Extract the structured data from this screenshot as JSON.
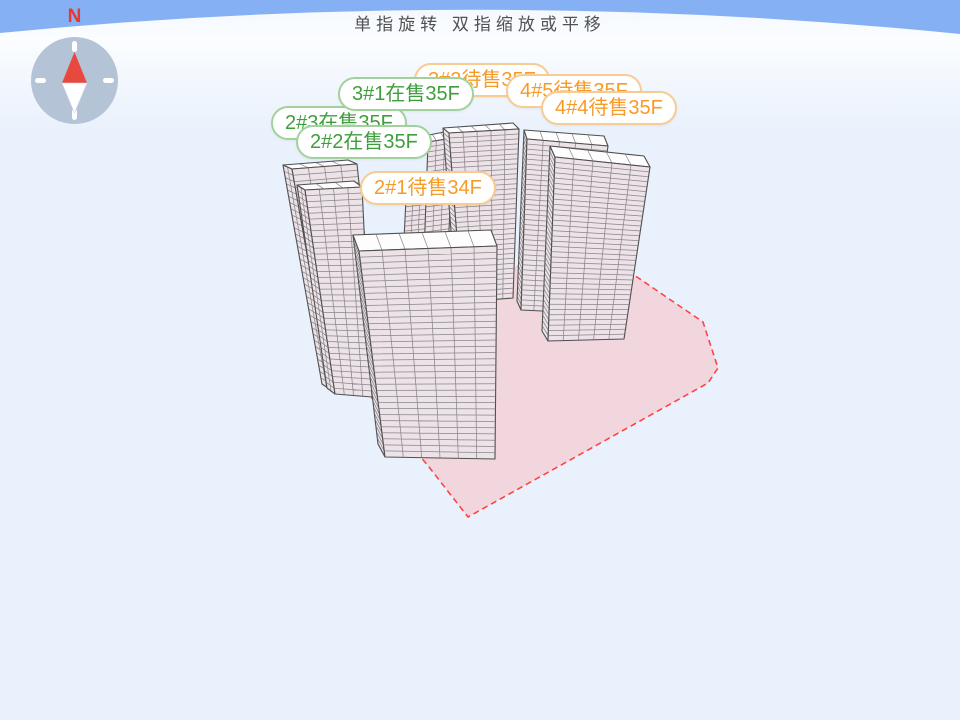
{
  "title": "单指旋转 双指缩放或平移",
  "compass": {
    "north_label": "N"
  },
  "labels": [
    {
      "id": "3-2",
      "text": "3#2待售35F",
      "status": "pending",
      "x": 414,
      "y": 63,
      "z": 1
    },
    {
      "id": "3-1",
      "text": "3#1在售35F",
      "status": "selling",
      "x": 338,
      "y": 77,
      "z": 2
    },
    {
      "id": "4-5",
      "text": "4#5待售35F",
      "status": "pending",
      "x": 506,
      "y": 74,
      "z": 3
    },
    {
      "id": "4-4",
      "text": "4#4待售35F",
      "status": "pending",
      "x": 541,
      "y": 91,
      "z": 4
    },
    {
      "id": "2-3",
      "text": "2#3在售35F",
      "status": "selling",
      "x": 271,
      "y": 106,
      "z": 1
    },
    {
      "id": "2-2",
      "text": "2#2在售35F",
      "status": "selling",
      "x": 296,
      "y": 125,
      "z": 2
    },
    {
      "id": "2-1",
      "text": "2#1待售34F",
      "status": "pending",
      "x": 360,
      "y": 171,
      "z": 2
    }
  ],
  "colors": {
    "sky_band": "#86b0f4",
    "bg_far": "#f2f7fe",
    "bg_glow": "#fbfdff",
    "bg_near": "#e9f1fc",
    "title_color": "#515151",
    "wall_fill": "#ece2e8",
    "roof_fill": "#fdfdfd",
    "grid_line": "#6f6f6f",
    "outline": "#4f4f4f",
    "ground_fill": "#f2d6dd",
    "ground_stroke": "#ff4242",
    "selling_text": "#3f9e3c",
    "selling_border": "#a3d19d",
    "pending_text": "#f79b28",
    "pending_border": "#f8cb92",
    "compass_circle": "#b5c3d7",
    "compass_tick": "#ffffff",
    "needle_red": "#e8493f",
    "needle_white": "#ffffff",
    "north_color": "#e8372c"
  },
  "scene": {
    "sky": {
      "left_y": 33,
      "ctrl_y": -14,
      "right_y": 34
    },
    "ground_polygon": [
      [
        371,
        397
      ],
      [
        500,
        268
      ],
      [
        560,
        262
      ],
      [
        637,
        277
      ],
      [
        703,
        322
      ],
      [
        718,
        368
      ],
      [
        708,
        383
      ],
      [
        468,
        517
      ],
      [
        429,
        467
      ]
    ],
    "buildings": [
      {
        "id": "back-tower-a",
        "faces": [
          {
            "kind": "wall",
            "p": [
              [
                407,
                178
              ],
              [
                428,
                175
              ],
              [
                424,
                258
              ],
              [
                403,
                260
              ]
            ],
            "rows": 16,
            "cols": 2
          }
        ]
      },
      {
        "id": "back-tower-b",
        "faces": [
          {
            "kind": "roof",
            "p": [
              [
                424,
                136
              ],
              [
                449,
                131
              ],
              [
                453,
                138
              ],
              [
                428,
                142
              ]
            ],
            "rows": 0,
            "cols": 2
          },
          {
            "kind": "wall",
            "p": [
              [
                428,
                142
              ],
              [
                453,
                138
              ],
              [
                448,
                254
              ],
              [
                424,
                257
              ]
            ],
            "rows": 22,
            "cols": 2
          }
        ]
      },
      {
        "id": "3-1",
        "faces": [
          {
            "kind": "wall",
            "p": [
              [
                443,
                128
              ],
              [
                449,
                133
              ],
              [
                462,
                302
              ],
              [
                456,
                295
              ]
            ],
            "rows": 33,
            "cols": 0
          },
          {
            "kind": "roof",
            "p": [
              [
                443,
                128
              ],
              [
                513,
                123
              ],
              [
                519,
                129
              ],
              [
                449,
                133
              ]
            ],
            "rows": 0,
            "cols": 4
          },
          {
            "kind": "wall",
            "p": [
              [
                449,
                133
              ],
              [
                519,
                129
              ],
              [
                513,
                298
              ],
              [
                462,
                302
              ]
            ],
            "rows": 33,
            "cols": 4
          }
        ]
      },
      {
        "id": "4-5",
        "faces": [
          {
            "kind": "wall",
            "p": [
              [
                524,
                130
              ],
              [
                527,
                139
              ],
              [
                521,
                310
              ],
              [
                517,
                301
              ]
            ],
            "rows": 33,
            "cols": 0
          },
          {
            "kind": "roof",
            "p": [
              [
                524,
                130
              ],
              [
                604,
                136
              ],
              [
                608,
                146
              ],
              [
                527,
                139
              ]
            ],
            "rows": 0,
            "cols": 4
          },
          {
            "kind": "wall",
            "p": [
              [
                527,
                139
              ],
              [
                608,
                146
              ],
              [
                585,
                313
              ],
              [
                521,
                310
              ]
            ],
            "rows": 33,
            "cols": 4
          }
        ]
      },
      {
        "id": "4-4",
        "faces": [
          {
            "kind": "wall",
            "p": [
              [
                550,
                146
              ],
              [
                555,
                157
              ],
              [
                548,
                341
              ],
              [
                542,
                331
              ]
            ],
            "rows": 34,
            "cols": 0
          },
          {
            "kind": "roof",
            "p": [
              [
                550,
                146
              ],
              [
                644,
                156
              ],
              [
                650,
                167
              ],
              [
                555,
                157
              ]
            ],
            "rows": 0,
            "cols": 4
          },
          {
            "kind": "wall",
            "p": [
              [
                555,
                157
              ],
              [
                650,
                167
              ],
              [
                624,
                339
              ],
              [
                548,
                341
              ]
            ],
            "rows": 34,
            "cols": 4
          }
        ]
      },
      {
        "id": "2-3",
        "faces": [
          {
            "kind": "wall",
            "p": [
              [
                283,
                165
              ],
              [
                292,
                169
              ],
              [
                331,
                390
              ],
              [
                322,
                384
              ]
            ],
            "rows": 34,
            "cols": 1
          },
          {
            "kind": "roof",
            "p": [
              [
                283,
                165
              ],
              [
                348,
                160
              ],
              [
                357,
                164
              ],
              [
                292,
                169
              ]
            ],
            "rows": 0,
            "cols": 3
          },
          {
            "kind": "wall",
            "p": [
              [
                292,
                169
              ],
              [
                357,
                164
              ],
              [
                380,
                382
              ],
              [
                331,
                390
              ]
            ],
            "rows": 34,
            "cols": 3
          }
        ]
      },
      {
        "id": "2-2",
        "faces": [
          {
            "kind": "wall",
            "p": [
              [
                297,
                185
              ],
              [
                305,
                190
              ],
              [
                335,
                394
              ],
              [
                327,
                388
              ]
            ],
            "rows": 34,
            "cols": 1
          },
          {
            "kind": "roof",
            "p": [
              [
                297,
                185
              ],
              [
                354,
                181
              ],
              [
                362,
                187
              ],
              [
                305,
                190
              ]
            ],
            "rows": 0,
            "cols": 2
          },
          {
            "kind": "wall",
            "p": [
              [
                305,
                190
              ],
              [
                362,
                187
              ],
              [
                372,
                397
              ],
              [
                335,
                394
              ]
            ],
            "rows": 34,
            "cols": 3
          }
        ]
      },
      {
        "id": "2-1",
        "faces": [
          {
            "kind": "wall",
            "p": [
              [
                353,
                235
              ],
              [
                359,
                251
              ],
              [
                385,
                457
              ],
              [
                378,
                444
              ]
            ],
            "rows": 33,
            "cols": 0
          },
          {
            "kind": "roof",
            "p": [
              [
                353,
                235
              ],
              [
                491,
                230
              ],
              [
                497,
                246
              ],
              [
                359,
                251
              ]
            ],
            "rows": 0,
            "cols": 5
          },
          {
            "kind": "wall",
            "p": [
              [
                359,
                251
              ],
              [
                497,
                246
              ],
              [
                495,
                459
              ],
              [
                385,
                457
              ]
            ],
            "rows": 33,
            "cols": 5
          }
        ]
      }
    ]
  }
}
